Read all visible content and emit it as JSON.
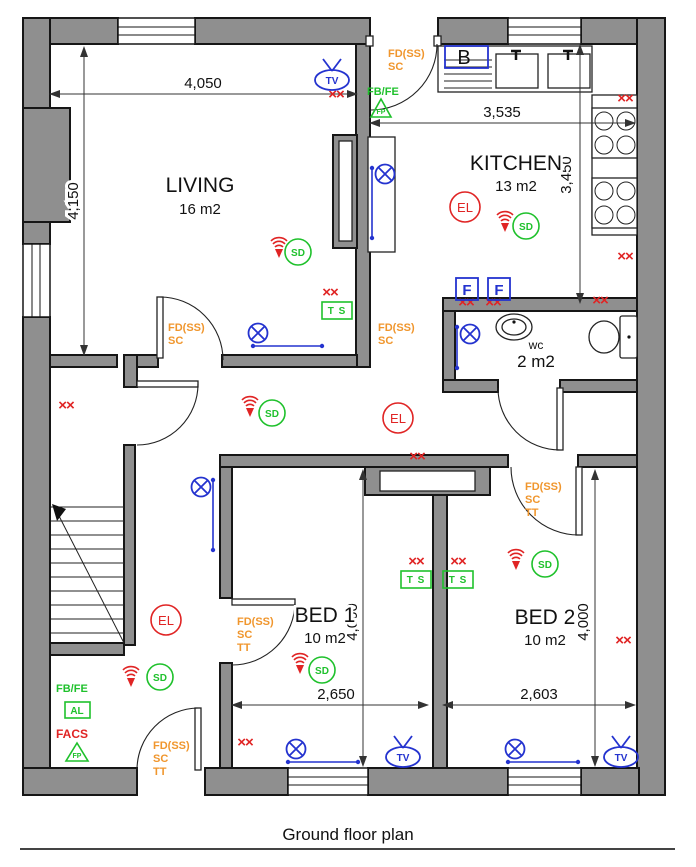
{
  "title": "Ground floor plan",
  "rooms": {
    "living": {
      "name": "LIVING",
      "area": "16 m2"
    },
    "kitchen": {
      "name": "KITCHEN",
      "area": "13 m2"
    },
    "wc": {
      "name": "wc",
      "area": "2 m2"
    },
    "bed1": {
      "name": "BED 1",
      "area": "10 m2"
    },
    "bed2": {
      "name": "BED 2",
      "area": "10 m2"
    }
  },
  "dimensions": {
    "living_width": "4,050",
    "living_depth": "4,150",
    "kitchen_width": "3,535",
    "kitchen_depth": "3,450",
    "bed1_width": "2,650",
    "bed2_width": "2,603",
    "bed1_depth": "4,000",
    "bed2_depth": "4,000"
  },
  "symbols": {
    "fire_door": "FD(SS)",
    "self_closing": "SC",
    "tt": "TT",
    "fb_fe": "FB/FE",
    "fire_point": "FP",
    "facs": "FACS",
    "alarm": "AL",
    "thermostat": "T S",
    "emergency_light": "EL",
    "smoke_detector": "SD",
    "tv_point": "TV",
    "fridge_freezer": "F",
    "boiler": "B",
    "double_socket": "××"
  },
  "colors": {
    "wall_gray": "#8f8f8f",
    "red": "#e02424",
    "green": "#1fc12c",
    "blue": "#2433cf",
    "orange": "#f0962d"
  }
}
